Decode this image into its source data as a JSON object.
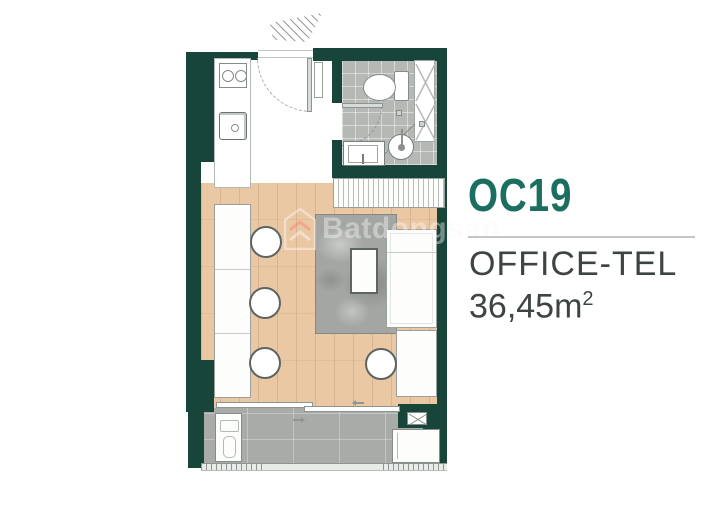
{
  "panel": {
    "unit_code": "OC19",
    "unit_type": "OFFICE-TEL",
    "area_value": "36,45",
    "area_unit": "m",
    "area_exponent": "2"
  },
  "watermark": {
    "brand": "Batdongsan"
  },
  "colors": {
    "wall": "#17453a",
    "accent": "#1c6f60",
    "wood": "#ebc8a4",
    "balcony": "#a9aba8",
    "bath_tile": "#b5b8b5",
    "rug": "#a4a6a3",
    "text_dark": "#3e4442",
    "furniture_line": "#9aa09e"
  },
  "floorplan": {
    "rooms": [
      "kitchen-entry",
      "bathroom",
      "living-work-area",
      "balcony"
    ],
    "fixtures": [
      "entry-hatch",
      "entry-door",
      "kitchen-counter",
      "stove",
      "kitchen-sink",
      "bathroom-door",
      "toilet",
      "shower",
      "vanity-sink",
      "floor-drain",
      "service-shaft",
      "wardrobe",
      "work-counter",
      "stool",
      "rug",
      "coffee-table",
      "sofa-bed",
      "side-desk",
      "sliding-door",
      "washer-unit",
      "ac-unit",
      "louver-vent",
      "balcony-railing"
    ]
  }
}
